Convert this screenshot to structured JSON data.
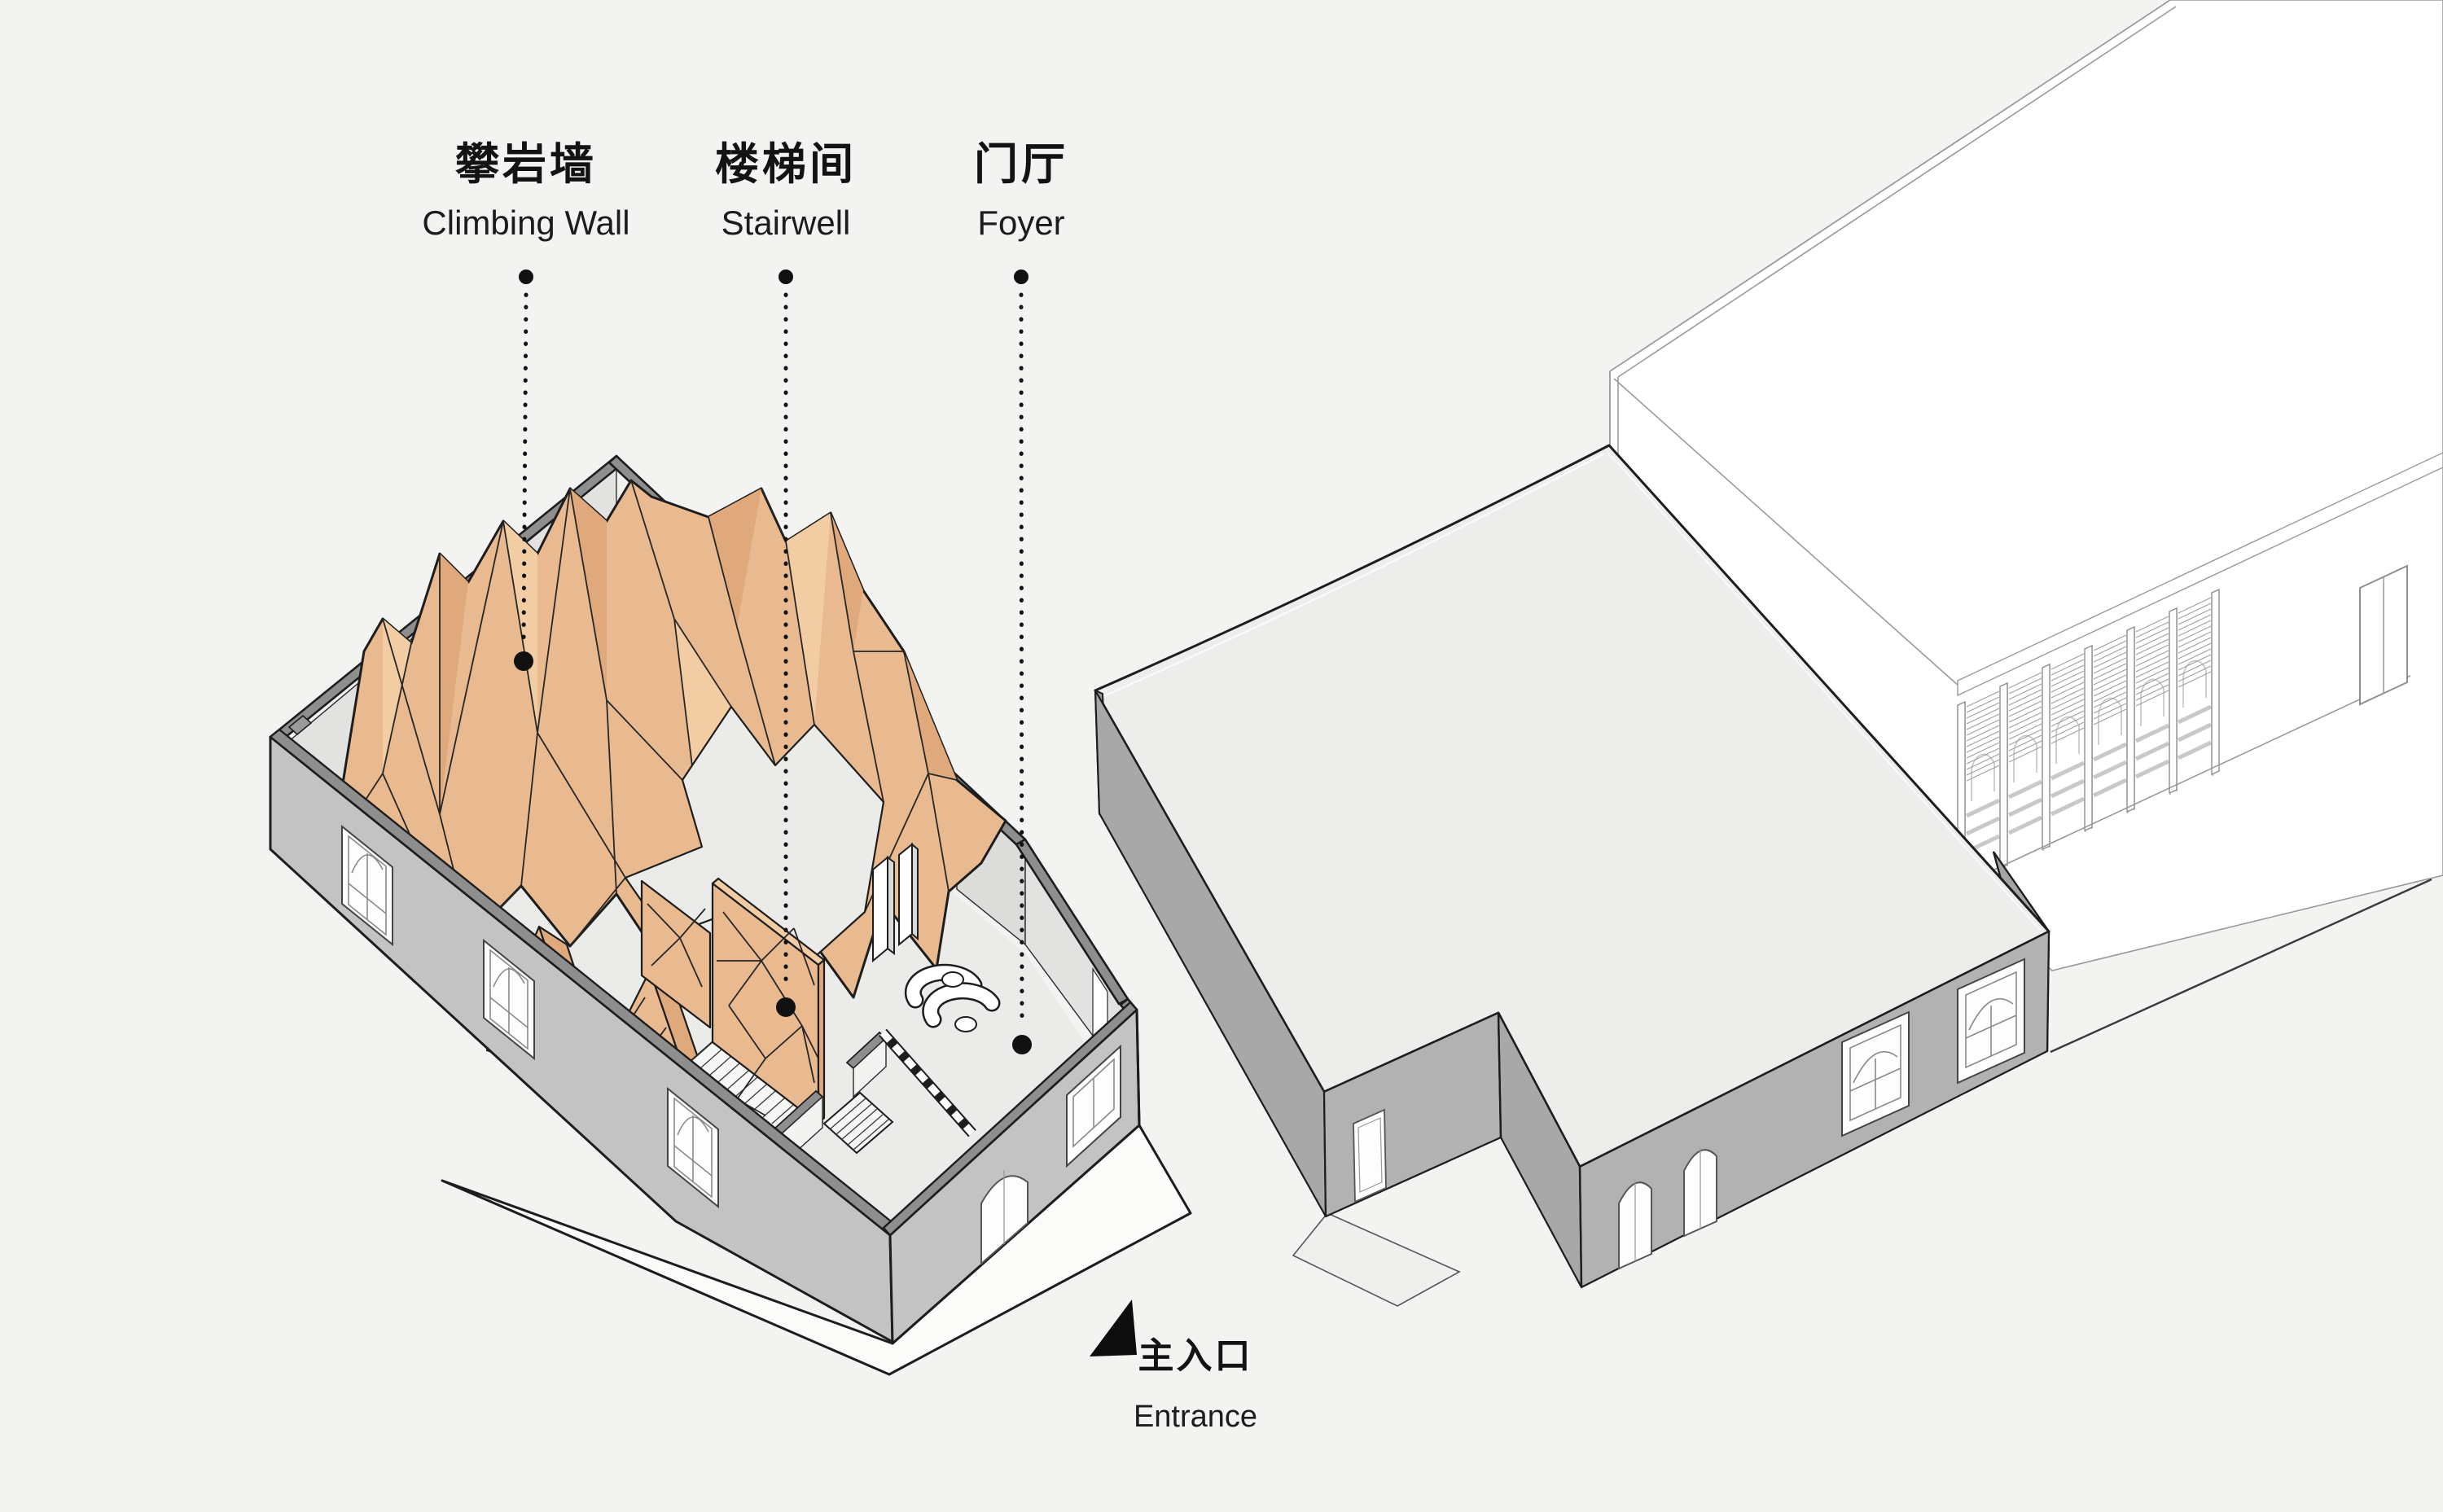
{
  "diagram": {
    "type": "architectural-axonometric",
    "callouts": [
      {
        "id": "climbing_wall",
        "zh": "攀岩墙",
        "en": "Climbing Wall"
      },
      {
        "id": "stairwell",
        "zh": "楼梯间",
        "en": "Stairwell"
      },
      {
        "id": "foyer",
        "zh": "门厅",
        "en": "Foyer"
      }
    ],
    "entrance": {
      "zh": "主入口",
      "en": "Entrance"
    }
  },
  "colors": {
    "bg": "#f3f3f1",
    "ink": "#1d1d1d",
    "wood": "#e9ba8f",
    "wood_dark": "#e0a97c",
    "wood_light": "#f2cda4",
    "wall": "#c3c3c3",
    "wall_dark": "#a8a8a8",
    "wall_mid": "#b2b2b2",
    "band": "#8e8e8e",
    "roof": "#ededeb",
    "interior": "#e2e2e0",
    "floor": "#ebebe9",
    "paper": "#ffffff",
    "thin": "#9a9a9a"
  }
}
